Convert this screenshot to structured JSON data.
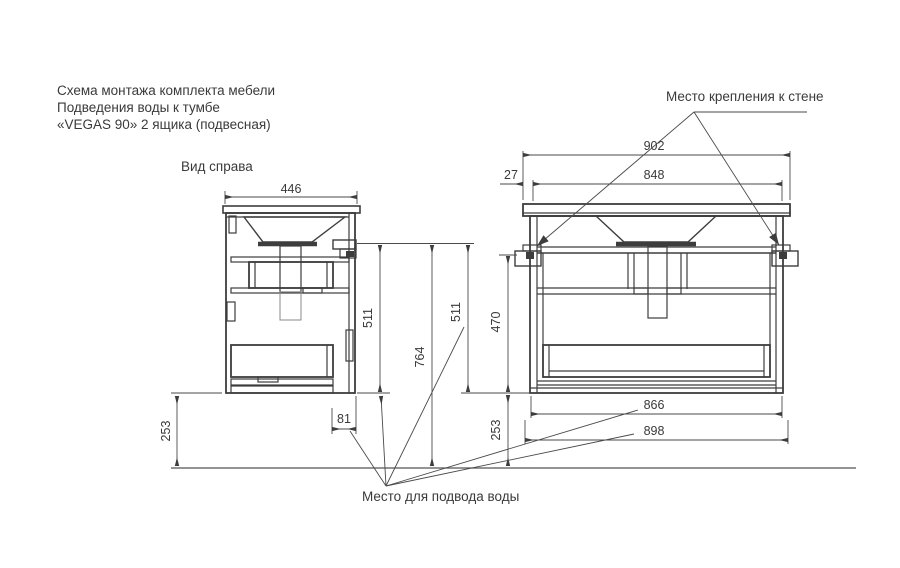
{
  "title": {
    "line1": "Схема монтажа комплекта мебели",
    "line2": "Подведения воды к тумбе",
    "line3": "«VEGAS 90» 2 ящика (подвесная)"
  },
  "side_view": {
    "label": "Вид справа",
    "dims": {
      "depth": "446",
      "height": "511",
      "floor_clearance": "253",
      "water_offset": "81"
    }
  },
  "front_view": {
    "dims": {
      "countertop_width": "902",
      "mount_offset": "27",
      "mount_span": "848",
      "mount_height": "511",
      "body_height": "470",
      "floor_clearance": "253",
      "inner_width": "866",
      "overall_width": "898"
    }
  },
  "shared_dims": {
    "total_height": "764"
  },
  "callouts": {
    "wall_mount": "Место крепления к стене",
    "water_supply": "Место для подвода воды"
  },
  "colors": {
    "background": "#ffffff",
    "line": "#3d3d3d",
    "dim_line": "#4a4a4a",
    "text": "#3a3a3a"
  }
}
